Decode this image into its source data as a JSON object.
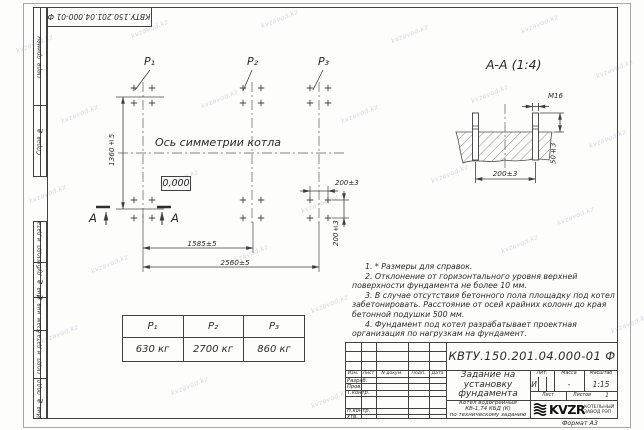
{
  "watermark": "kvzavod.kz",
  "corner_stamp": "КВТУ.150.201.04.000-01 Ф",
  "margin": {
    "perv": "Перв. примен.",
    "sprav": "Справ. №",
    "podp1": "Подп. и дата",
    "inv_dubl": "Инв. № дубл.",
    "vzam": "Взам. инв. №",
    "podp2": "Подп. и дата",
    "inv_podl": "Инв. № подл."
  },
  "plan": {
    "p1": "Р₁",
    "p2": "Р₂",
    "p3": "Р₃",
    "axis_label": "Ось симметрии котла",
    "elevation": "0,000",
    "dim_height": "1360±5",
    "dim_1585": "1585±5",
    "dim_2560": "2560±5",
    "dim_200_h": "200±3",
    "dim_200_v": "200±3",
    "section_letter_left": "А",
    "section_letter_right": "А"
  },
  "section": {
    "title": "А-А (1:4)",
    "bolt": "М16",
    "dim_width": "200±3",
    "dim_height": "50±3"
  },
  "load_table": {
    "headers": [
      "Р₁",
      "Р₂",
      "Р₃"
    ],
    "values": [
      "630 кг",
      "2700 кг",
      "860 кг"
    ]
  },
  "notes": [
    "1. * Размеры для справок.",
    "2. Отклонение от горизонтального уровня верхней поверхности фундамента не более 10 мм.",
    "3. В случае отсутствия бетонного пола площадку под котел забетонировать. Расстояние от осей крайних колонн до края бетонной подушки 500 мм.",
    "4. Фундамент под котел разрабатывает проектная организация по нагрузкам на фундамент."
  ],
  "title_block": {
    "designation": "КВТУ.150.201.04.000-01 Ф",
    "title_l1": "Задание на",
    "title_l2": "установку",
    "title_l3": "фундамента",
    "product_l1": "Котел водогрейный",
    "product_l2": "КВ-1,74 КБД (К)",
    "product_l3": "по техническому заданию",
    "header_cols": [
      "Изм.",
      "Лист",
      "N докум.",
      "Подп.",
      "Дата"
    ],
    "rows": [
      "Разраб.",
      "Пров.",
      "Т.контр.",
      "Н.контр.",
      "Утв."
    ],
    "lit_label": "Лит.",
    "mass_label": "Масса",
    "scale_label": "Масштаб",
    "lit_value": "И",
    "mass_value": "-",
    "scale_value": "1:15",
    "sheet_label": "Лист",
    "sheets_label": "Листов",
    "sheets_value": "1",
    "logo_text": "KVZR",
    "company_l1": "КОТЕЛЬНЫЙ",
    "company_l2": "ЗАВОД РЭП",
    "format_note": "Формат А3"
  }
}
